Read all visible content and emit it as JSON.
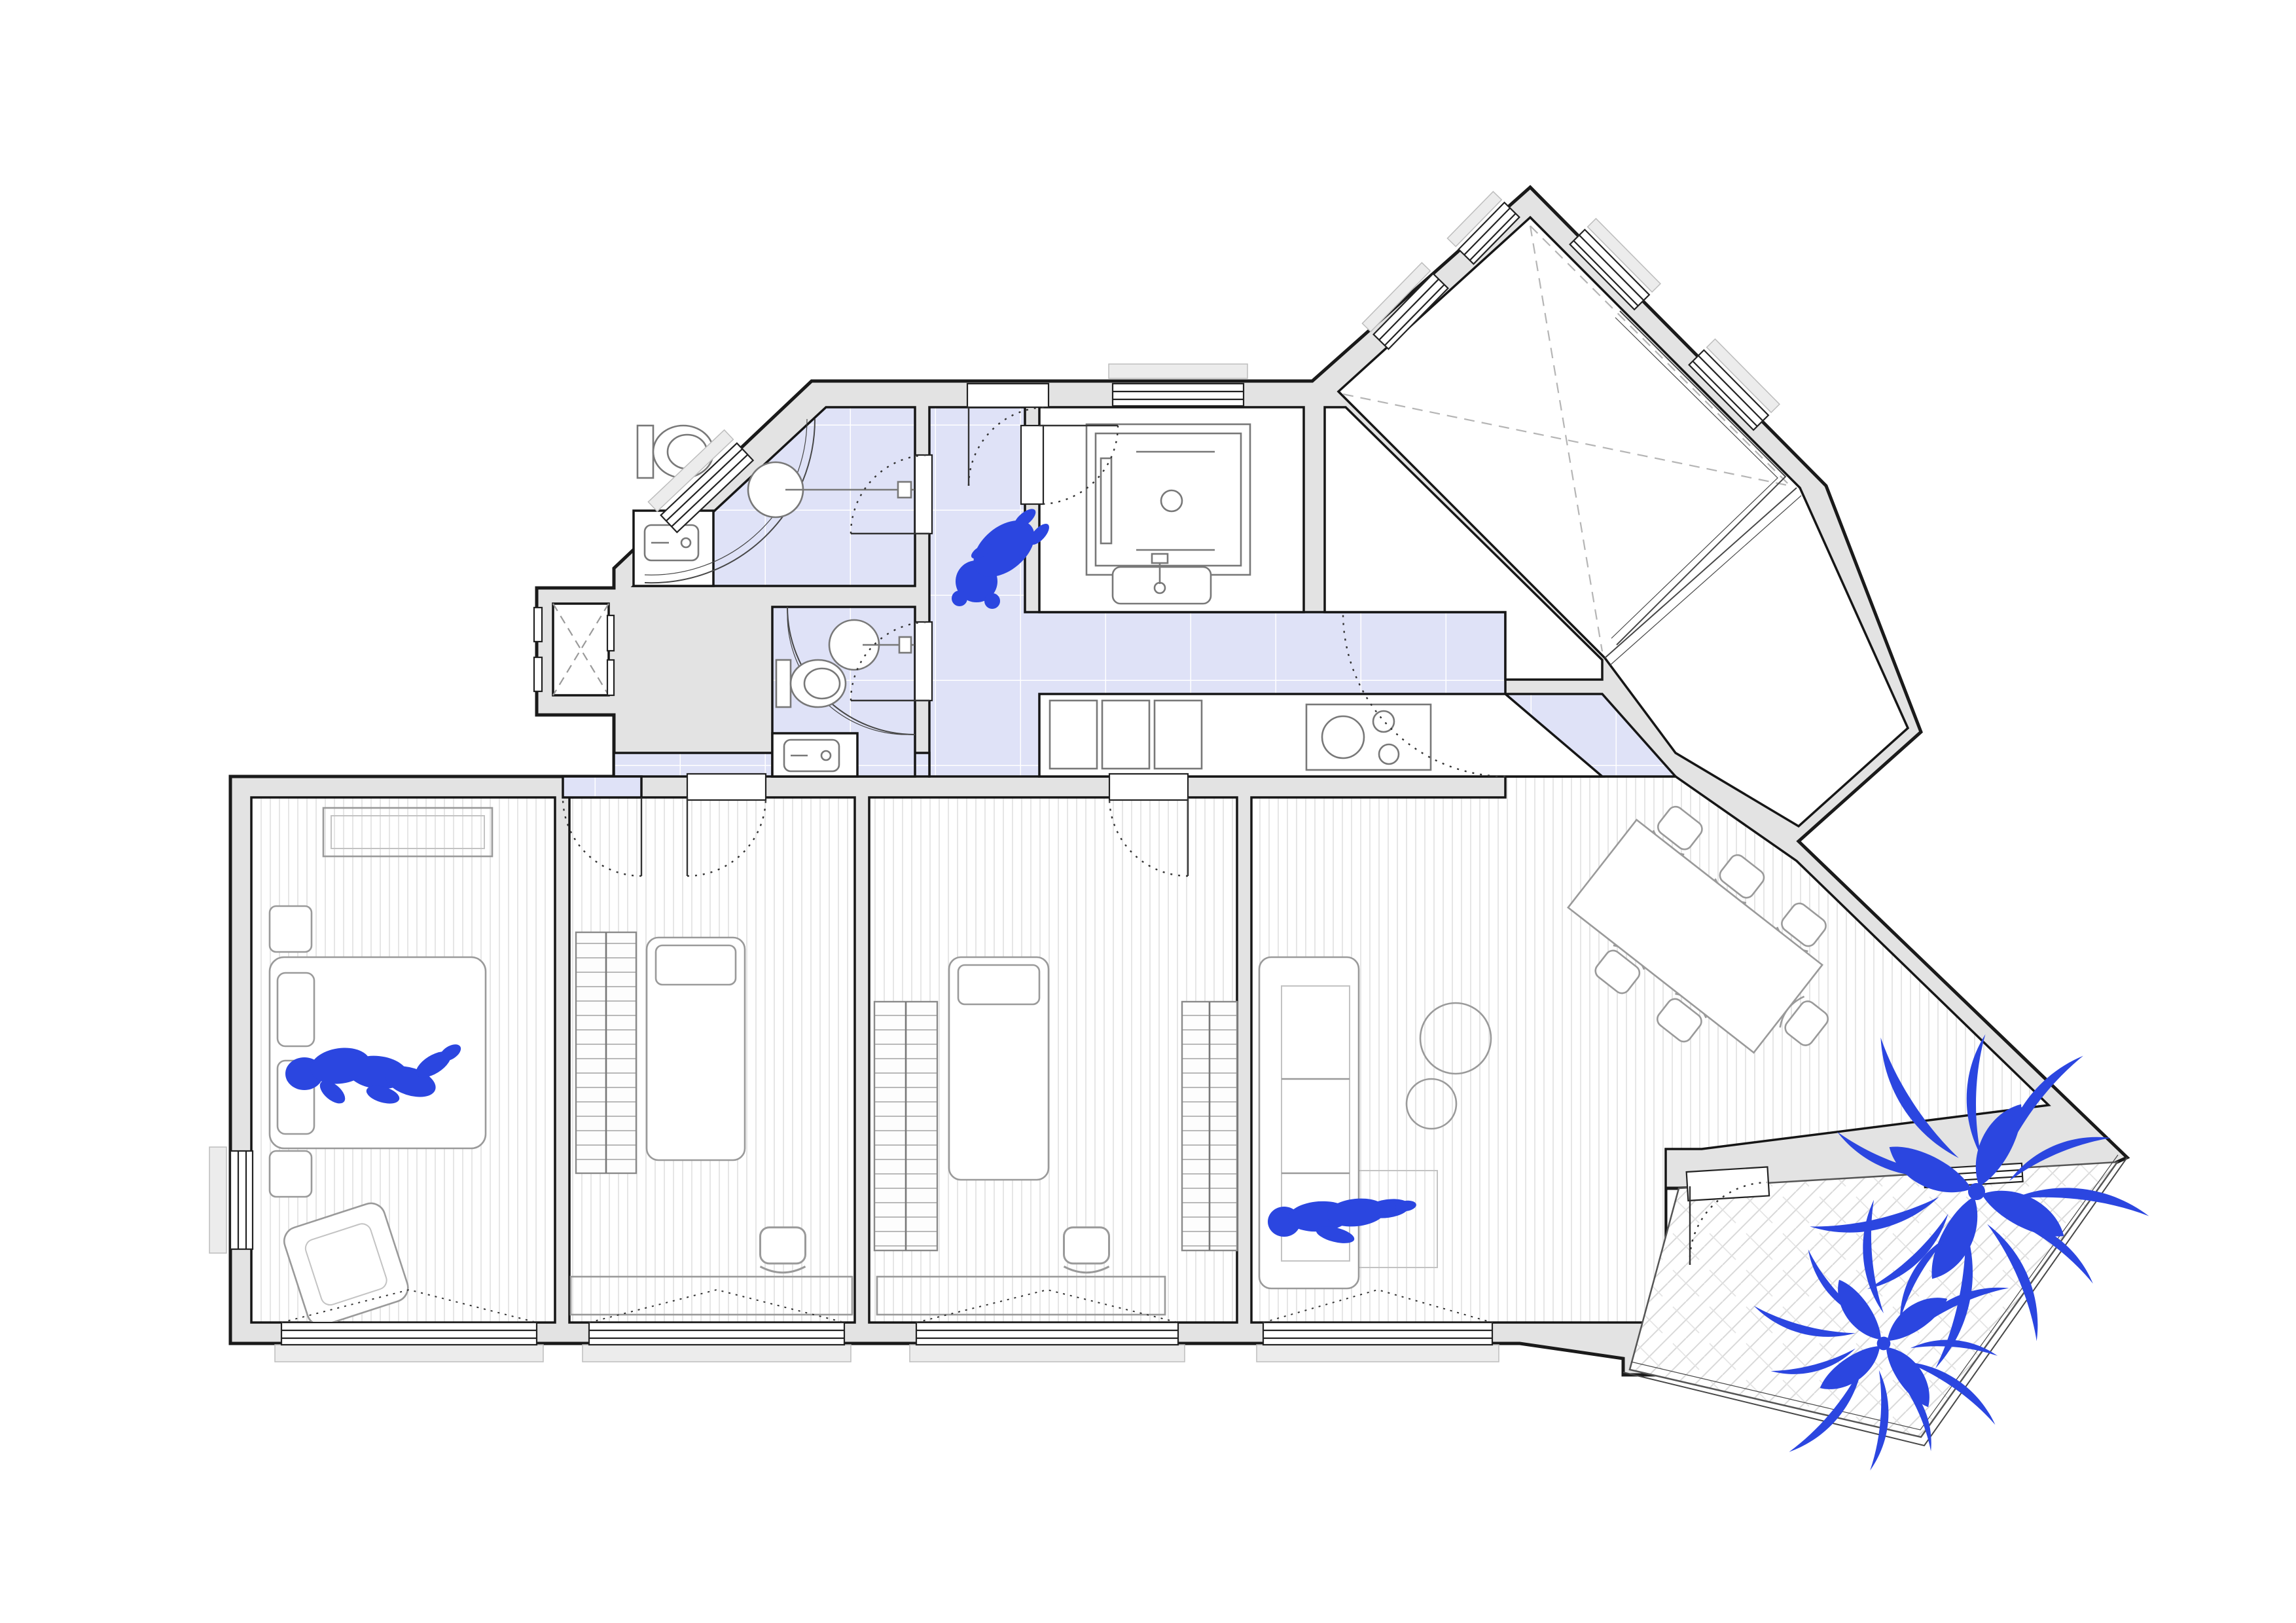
{
  "page": {
    "title": "apartment-floor-plan",
    "kind": "architectural plan drawing, top view, no text labels",
    "background": "#ffffff"
  },
  "colors": {
    "accent_blue": "#2b46e0",
    "zone_lavender": "#dfe2f7",
    "wall_fill": "#e3e3e3",
    "wall_outline": "#1a1a1a",
    "furniture_stroke": "#9a9a9a",
    "fixture_stroke": "#787878",
    "floor_stripe": "#e6e6e6",
    "tile_line": "#ffffff",
    "herringbone_line": "#d9d9d9",
    "dashed_gray": "#b5b5b5",
    "door_arc": "#333333",
    "paper": "#ffffff"
  },
  "rooms": [
    {
      "id": "master-bedroom",
      "floor": "striped wood",
      "contents": [
        "double bed",
        "two pillows",
        "nightstand x2",
        "dresser",
        "armchair",
        "person lying on bed"
      ]
    },
    {
      "id": "bedroom-2",
      "floor": "striped wood",
      "contents": [
        "single bed",
        "wardrobe",
        "desk",
        "chair"
      ]
    },
    {
      "id": "bedroom-3",
      "floor": "striped wood",
      "contents": [
        "single bed",
        "wardrobe x2",
        "desk",
        "chair"
      ]
    },
    {
      "id": "living-dining-room",
      "floor": "striped wood",
      "contents": [
        "sofa",
        "rug",
        "round coffee table x2",
        "rotated dining table",
        "dining chair x6",
        "person lying on sofa"
      ]
    },
    {
      "id": "corridor",
      "floor": "lavender tile",
      "contents": [
        "dog silhouette"
      ]
    },
    {
      "id": "bathroom-1",
      "floor": "lavender tile",
      "contents": [
        "toilet",
        "round washbasin",
        "rectangular sink niche",
        "curved shower screen"
      ]
    },
    {
      "id": "bathroom-2",
      "floor": "lavender tile",
      "contents": [
        "toilet",
        "round washbasin",
        "rectangular sink niche",
        "curved shower screen"
      ]
    },
    {
      "id": "kitchen",
      "floor": "white",
      "contents": [
        "base cabinets x3",
        "cooktop with burners",
        "counter"
      ]
    },
    {
      "id": "laundry",
      "floor": "white",
      "contents": [
        "washing machine",
        "counter sink"
      ]
    },
    {
      "id": "sunroom-diamond",
      "floor": "white with dashed ceiling lines",
      "contents": [
        "glass partitions",
        "perimeter windows"
      ]
    },
    {
      "id": "terrace",
      "floor": "herringbone tile",
      "contents": [
        "palm plant large",
        "palm plant small",
        "open parapet edge"
      ]
    },
    {
      "id": "elevator",
      "floor": "white",
      "contents": [
        "dashed X cab symbol",
        "sliding doors"
      ]
    }
  ],
  "figures": [
    {
      "id": "person-on-bed",
      "color_key": "accent_blue"
    },
    {
      "id": "person-on-sofa",
      "color_key": "accent_blue"
    },
    {
      "id": "dog-in-corridor",
      "color_key": "accent_blue"
    },
    {
      "id": "palm-plant-large",
      "color_key": "accent_blue"
    },
    {
      "id": "palm-plant-small",
      "color_key": "accent_blue"
    }
  ],
  "counts": {
    "bedrooms": 3,
    "bathrooms": 2,
    "people": 2,
    "animals": 1,
    "plants": 2,
    "dining_chairs": 6,
    "bottom_windows": 4
  }
}
